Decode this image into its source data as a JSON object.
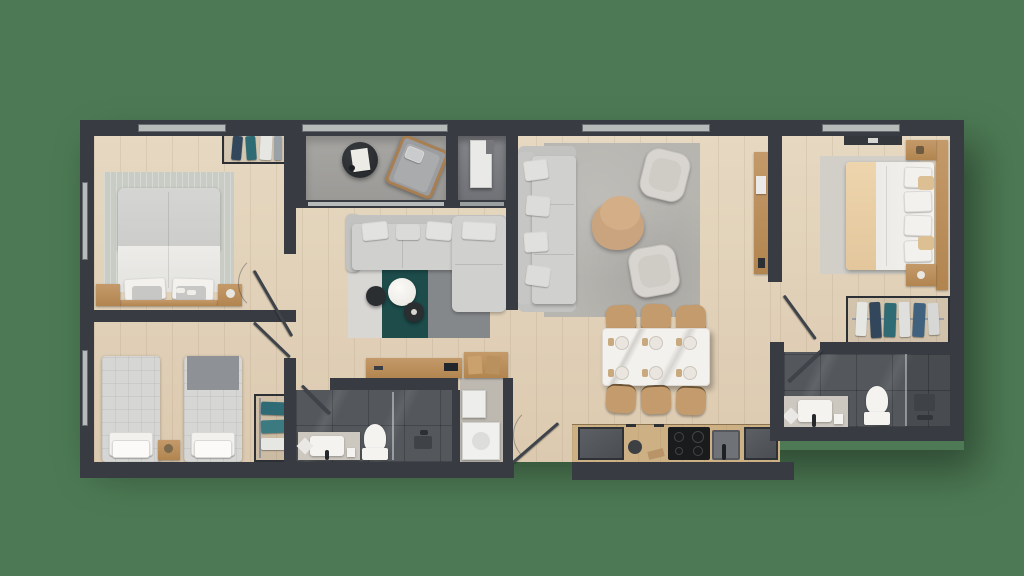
{
  "title": "Apartment floor plan — top-down 3D render",
  "palette": {
    "bg": "#4d7a54",
    "wall": "#383c42",
    "window": "#b7bcba",
    "tile": "#54585c",
    "balcony": "#a3a2a0",
    "utility": "#7b7d80",
    "sofa": "#d0d0ce",
    "sofaDark": "#c2c2c0",
    "rugTeal": "#1d4c4b",
    "rugGray": "#85888b",
    "rugLight": "#d8d7d4",
    "rugBedroom": "#c9ccc5",
    "rugLounge": "#b7b5b0",
    "rugMaster": "#d2cfc9",
    "counter": "#cdb084",
    "marble": "#f3f1ed",
    "chairTan": "#c49b6c",
    "tableTan": "#c9a47e",
    "appliance": "#53575b",
    "cooktop": "#191b1d",
    "whiteFixture": "#f4f3f0",
    "stone": "#ccc8c0",
    "blanketTan": "#ead0a8",
    "quilt": "#d6d6d4",
    "throwGray": "#8e9296",
    "navyCloth": "#33475c",
    "tealCloth": "#2f6b74",
    "whiteCloth": "#e6e6e2",
    "darkTable": "#2b2e31",
    "leaf": "#3f444b"
  },
  "floorplan": {
    "rooms": [
      {
        "id": "bedroom-1",
        "name": "Bedroom 1"
      },
      {
        "id": "bedroom-2",
        "name": "Bedroom 2"
      },
      {
        "id": "bathroom-1",
        "name": "Bathroom"
      },
      {
        "id": "laundry",
        "name": "Laundry Nook"
      },
      {
        "id": "living-room",
        "name": "Living / TV Room"
      },
      {
        "id": "balcony",
        "name": "Balcony Terrace"
      },
      {
        "id": "utility-balcony",
        "name": "Utility Balcony"
      },
      {
        "id": "entry",
        "name": "Entry"
      },
      {
        "id": "lounge",
        "name": "Lounge"
      },
      {
        "id": "dining-area",
        "name": "Dining Area"
      },
      {
        "id": "kitchen",
        "name": "Kitchen"
      },
      {
        "id": "hallway",
        "name": "Master Hallway"
      },
      {
        "id": "master-bedroom",
        "name": "Master Bedroom"
      },
      {
        "id": "walk-in-closet",
        "name": "Walk-in Closet"
      },
      {
        "id": "master-bathroom",
        "name": "Master Bathroom"
      }
    ],
    "furniture": {
      "bedroom_1": [
        "double-bed",
        "rug",
        "nightstand-left",
        "nightstand-right",
        "open-wardrobe-rack",
        "slippers"
      ],
      "bedroom_2": [
        "single-bed-left",
        "single-bed-right",
        "nightstand",
        "open-wardrobe-rack"
      ],
      "bathroom_1": [
        "vanity-sink",
        "toilet",
        "shower",
        "bath-mat"
      ],
      "laundry": [
        "stacked-washer",
        "dryer",
        "storage-shelf"
      ],
      "living_room": [
        "sectional-sofa",
        "chaise",
        "three-tone-rug",
        "round-coffee-table",
        "side-tables",
        "tv-console"
      ],
      "balcony": [
        "round-table",
        "lounge-chair"
      ],
      "utility_balcony": [
        "ac-unit"
      ],
      "lounge": [
        "sofa",
        "armchair-top",
        "armchair-bottom",
        "organic-coffee-table",
        "area-rug",
        "wall-console"
      ],
      "dining_area": [
        "marble-dining-table",
        "six-chairs",
        "place-settings"
      ],
      "kitchen": [
        "counter-run",
        "fridge",
        "cooktop",
        "sink",
        "oven",
        "waste-bin"
      ],
      "master_bedroom": [
        "double-bed",
        "rug",
        "nightstand-top",
        "nightstand-bottom",
        "headboard-wardrobe",
        "media-unit"
      ],
      "walk_in_closet": [
        "clothes-rail",
        "hanging-garments"
      ],
      "master_bathroom": [
        "vanity-sink",
        "toilet",
        "walk-in-shower",
        "bath-mat"
      ]
    }
  }
}
